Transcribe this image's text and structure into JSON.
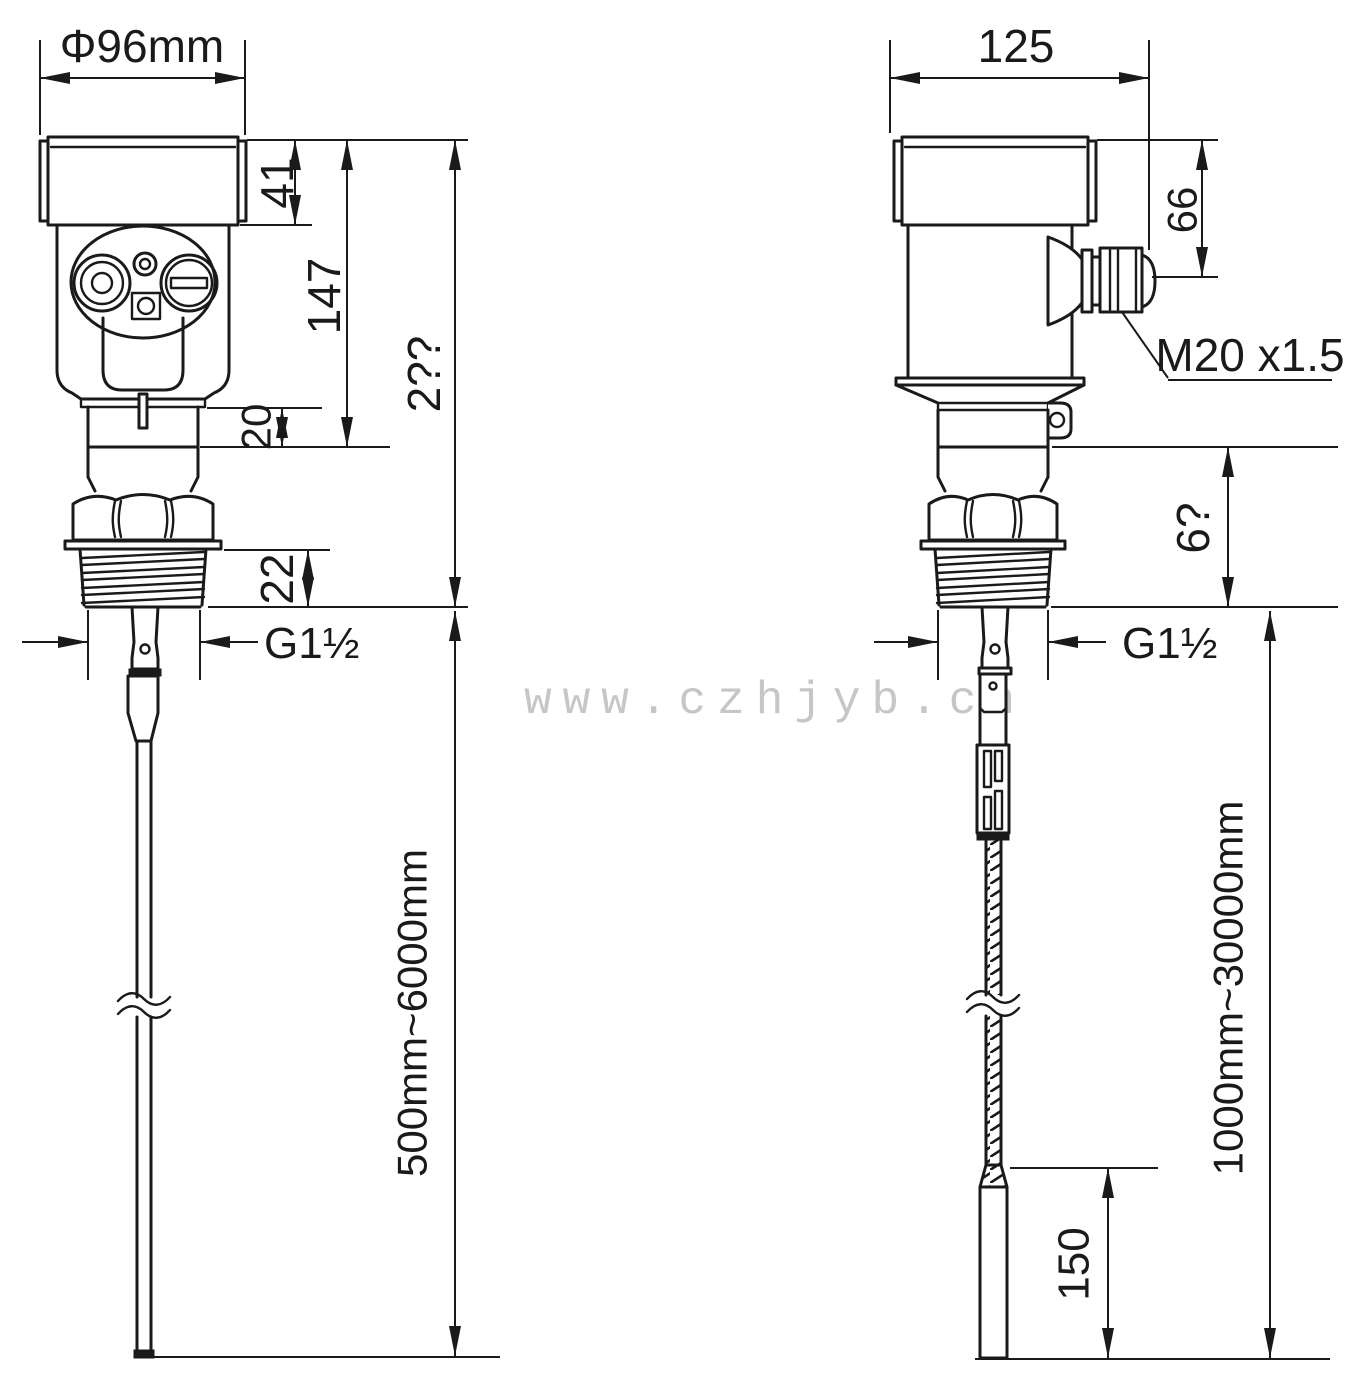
{
  "drawing": {
    "watermark": "www.czhjyb.cn",
    "left_view": {
      "top_diameter": "Φ96mm",
      "cap_height": "41",
      "head_height": "147",
      "overall_height": "2??",
      "neck_height": "20",
      "thread_length": "22",
      "process_thread": "G1½",
      "probe_range": "500mm~6000mm"
    },
    "right_view": {
      "top_width": "125",
      "gland_height": "66",
      "gland_thread": "M20 x1.5",
      "lower_section": "6?",
      "process_thread": "G1½",
      "probe_range": "1000mm~30000mm",
      "weight_length": "150"
    }
  }
}
